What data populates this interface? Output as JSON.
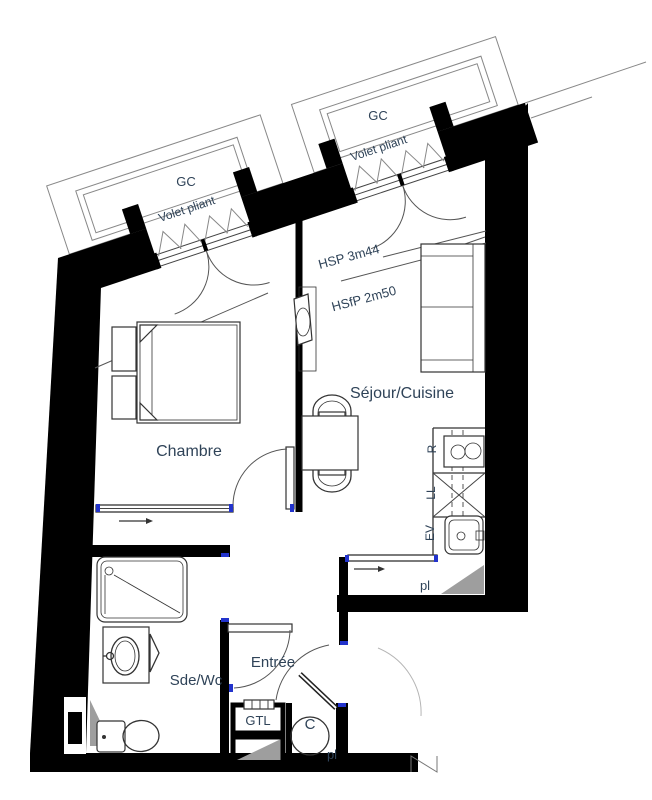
{
  "document_type": "architectural-floor-plan",
  "labels": {
    "gc_left": "GC",
    "gc_right": "GC",
    "volet_left": "Volet pliant",
    "volet_right": "Volet pliant",
    "hsp": "HSP 3m44",
    "hsfp": "HSfP 2m50",
    "sejour": "Séjour/Cuisine",
    "chambre": "Chambre",
    "sdewc": "Sde/Wc",
    "entree": "Entrée",
    "gtl": "GTL",
    "water_heater": "C",
    "fridge": "R",
    "washing_machine": "LL",
    "kitchen_sink": "EV",
    "closet_kitchen": "pl",
    "closet_entree": "pl"
  },
  "colors": {
    "wall": "#000000",
    "label_text": "#2F4358",
    "door_jamb_blue": "#2233cc",
    "duct_gray": "#9e9e9e",
    "balcony_outline": "#888888"
  }
}
